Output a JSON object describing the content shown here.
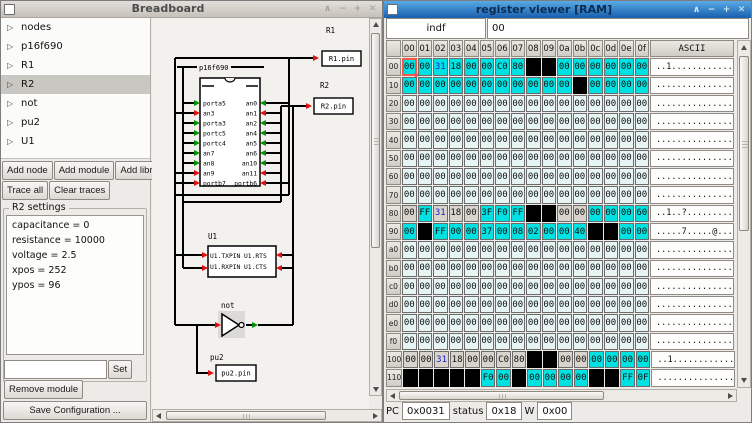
{
  "breadboard": {
    "title": "Breadboard",
    "tree": {
      "items": [
        "nodes",
        "p16f690",
        "R1",
        "R2",
        "not",
        "pu2",
        "U1"
      ],
      "selected": "R2"
    },
    "buttons": {
      "add_node": "Add node",
      "add_module": "Add module",
      "add_library": "Add library",
      "trace_all": "Trace all",
      "clear_traces": "Clear traces",
      "set": "Set",
      "remove_module": "Remove module",
      "save_configuration": "Save Configuration ..."
    },
    "settings": {
      "frame_label": "R2 settings",
      "attributes": [
        "capacitance = 0",
        "resistance = 10000",
        "voltage = 2.5",
        "xpos = 252",
        "ypos = 96"
      ],
      "entry_value": ""
    },
    "canvas": {
      "chip": {
        "label": "p16f690",
        "left_pins": [
          "porta5",
          "an3",
          "porta3",
          "portc5",
          "portc4",
          "an7",
          "an8",
          "an9",
          "portb7"
        ],
        "right_pins": [
          "an0",
          "an1",
          "an2",
          "an4",
          "an5",
          "an6",
          "an10",
          "an11",
          "portb6"
        ],
        "left_pin_colors": "grgggggrr",
        "right_pin_colors": "grgggggrr"
      },
      "r1": {
        "label": "R1",
        "pin_label": "R1.pin"
      },
      "r2": {
        "label": "R2",
        "pin_label": "R2.pin"
      },
      "u1": {
        "label": "U1",
        "row1_left": "U1.TXPIN",
        "row1_right": "U1.RTS",
        "row2_left": "U1.RXPIN",
        "row2_right": "U1.CTS"
      },
      "not_gate": {
        "label": "not"
      },
      "pu2": {
        "label": "pu2",
        "pin_label": "pu2.pin"
      },
      "colors": {
        "wire": "#000000",
        "red_arrow": "#e01010",
        "green_arrow": "#009000"
      }
    }
  },
  "register_viewer": {
    "title": "register viewer [RAM]",
    "register_name": "indf",
    "register_value": "00",
    "ascii_header": "ASCII",
    "col_headers": [
      "00",
      "01",
      "02",
      "03",
      "04",
      "05",
      "06",
      "07",
      "08",
      "09",
      "0a",
      "0b",
      "0c",
      "0d",
      "0e",
      "0f"
    ],
    "colors": {
      "cyan": "#00e2e2",
      "light": "#e6f4f4",
      "gray": "#d8d4cc",
      "black": "#000000",
      "blue_text": "#2020cc",
      "selection": "#f4574a"
    },
    "rows": [
      {
        "addr": "00",
        "values": [
          "00",
          "00",
          "31",
          "18",
          "00",
          "00",
          "C0",
          "80",
          "",
          "",
          "00",
          "00",
          "00",
          "00",
          "00",
          "00"
        ],
        "bg": "cccccccckkcccccc",
        "fg": "..b.............",
        "ascii": "..1.............",
        "sel": 0
      },
      {
        "addr": "10",
        "values": [
          "00",
          "00",
          "00",
          "00",
          "00",
          "00",
          "00",
          "00",
          "00",
          "00",
          "00",
          "",
          "00",
          "00",
          "00",
          "00"
        ],
        "bg": "ccccccccccckcccc",
        "fg": "................",
        "ascii": "................"
      },
      {
        "addr": "20",
        "values": [
          "00",
          "00",
          "00",
          "00",
          "00",
          "00",
          "00",
          "00",
          "00",
          "00",
          "00",
          "00",
          "00",
          "00",
          "00",
          "00"
        ],
        "bg": "llllllllllllllll",
        "fg": "................",
        "ascii": "................"
      },
      {
        "addr": "30",
        "values": [
          "00",
          "00",
          "00",
          "00",
          "00",
          "00",
          "00",
          "00",
          "00",
          "00",
          "00",
          "00",
          "00",
          "00",
          "00",
          "00"
        ],
        "bg": "llllllllllllllll",
        "fg": "................",
        "ascii": "................"
      },
      {
        "addr": "40",
        "values": [
          "00",
          "00",
          "00",
          "00",
          "00",
          "00",
          "00",
          "00",
          "00",
          "00",
          "00",
          "00",
          "00",
          "00",
          "00",
          "00"
        ],
        "bg": "llllllllllllllll",
        "fg": "................",
        "ascii": "................"
      },
      {
        "addr": "50",
        "values": [
          "00",
          "00",
          "00",
          "00",
          "00",
          "00",
          "00",
          "00",
          "00",
          "00",
          "00",
          "00",
          "00",
          "00",
          "00",
          "00"
        ],
        "bg": "llllllllllllllll",
        "fg": "................",
        "ascii": "................"
      },
      {
        "addr": "60",
        "values": [
          "00",
          "00",
          "00",
          "00",
          "00",
          "00",
          "00",
          "00",
          "00",
          "00",
          "00",
          "00",
          "00",
          "00",
          "00",
          "00"
        ],
        "bg": "llllllllllllllll",
        "fg": "................",
        "ascii": "................"
      },
      {
        "addr": "70",
        "values": [
          "00",
          "00",
          "00",
          "00",
          "00",
          "00",
          "00",
          "00",
          "00",
          "00",
          "00",
          "00",
          "00",
          "00",
          "00",
          "00"
        ],
        "bg": "llllllllllllllll",
        "fg": "................",
        "ascii": "................"
      },
      {
        "addr": "80",
        "values": [
          "00",
          "FF",
          "31",
          "18",
          "00",
          "3F",
          "F0",
          "FF",
          "",
          "",
          "00",
          "00",
          "00",
          "00",
          "00",
          "60"
        ],
        "bg": "gcgggccckkggcccc",
        "fg": "..b.............",
        "ascii": "..1..?.........`"
      },
      {
        "addr": "90",
        "values": [
          "00",
          "",
          "FF",
          "00",
          "00",
          "37",
          "00",
          "08",
          "02",
          "00",
          "00",
          "40",
          "",
          "",
          "00",
          "00"
        ],
        "bg": "ckcccccccccckkcc",
        "fg": "................",
        "ascii": ".....7.....@...."
      },
      {
        "addr": "a0",
        "values": [
          "00",
          "00",
          "00",
          "00",
          "00",
          "00",
          "00",
          "00",
          "00",
          "00",
          "00",
          "00",
          "00",
          "00",
          "00",
          "00"
        ],
        "bg": "llllllllllllllll",
        "fg": "................",
        "ascii": "................"
      },
      {
        "addr": "b0",
        "values": [
          "00",
          "00",
          "00",
          "00",
          "00",
          "00",
          "00",
          "00",
          "00",
          "00",
          "00",
          "00",
          "00",
          "00",
          "00",
          "00"
        ],
        "bg": "llllllllllllllll",
        "fg": "................",
        "ascii": "................"
      },
      {
        "addr": "c0",
        "values": [
          "00",
          "00",
          "00",
          "00",
          "00",
          "00",
          "00",
          "00",
          "00",
          "00",
          "00",
          "00",
          "00",
          "00",
          "00",
          "00"
        ],
        "bg": "llllllllllllllll",
        "fg": "................",
        "ascii": "................"
      },
      {
        "addr": "d0",
        "values": [
          "00",
          "00",
          "00",
          "00",
          "00",
          "00",
          "00",
          "00",
          "00",
          "00",
          "00",
          "00",
          "00",
          "00",
          "00",
          "00"
        ],
        "bg": "llllllllllllllll",
        "fg": "................",
        "ascii": "................"
      },
      {
        "addr": "e0",
        "values": [
          "00",
          "00",
          "00",
          "00",
          "00",
          "00",
          "00",
          "00",
          "00",
          "00",
          "00",
          "00",
          "00",
          "00",
          "00",
          "00"
        ],
        "bg": "llllllllllllllll",
        "fg": "................",
        "ascii": "................"
      },
      {
        "addr": "f0",
        "values": [
          "00",
          "00",
          "00",
          "00",
          "00",
          "00",
          "00",
          "00",
          "00",
          "00",
          "00",
          "00",
          "00",
          "00",
          "00",
          "00"
        ],
        "bg": "llllllllllllllll",
        "fg": "................",
        "ascii": "................"
      },
      {
        "addr": "100",
        "values": [
          "00",
          "00",
          "31",
          "18",
          "00",
          "00",
          "C0",
          "80",
          "",
          "",
          "00",
          "00",
          "00",
          "00",
          "00",
          "00"
        ],
        "bg": "ggggggggkkggcccc",
        "fg": "..b.............",
        "ascii": "..1............."
      },
      {
        "addr": "110",
        "values": [
          "",
          "",
          "",
          "",
          "",
          "F0",
          "00",
          "",
          "00",
          "00",
          "00",
          "00",
          "",
          "",
          "FF",
          "0F"
        ],
        "bg": "kkkkkcckcccckkcc",
        "fg": "................",
        "ascii": "................"
      }
    ],
    "status": {
      "pc_label": "PC",
      "pc_value": "0x0031",
      "status_label": "status",
      "status_value": "0x18",
      "w_label": "W",
      "w_value": "0x00"
    }
  }
}
